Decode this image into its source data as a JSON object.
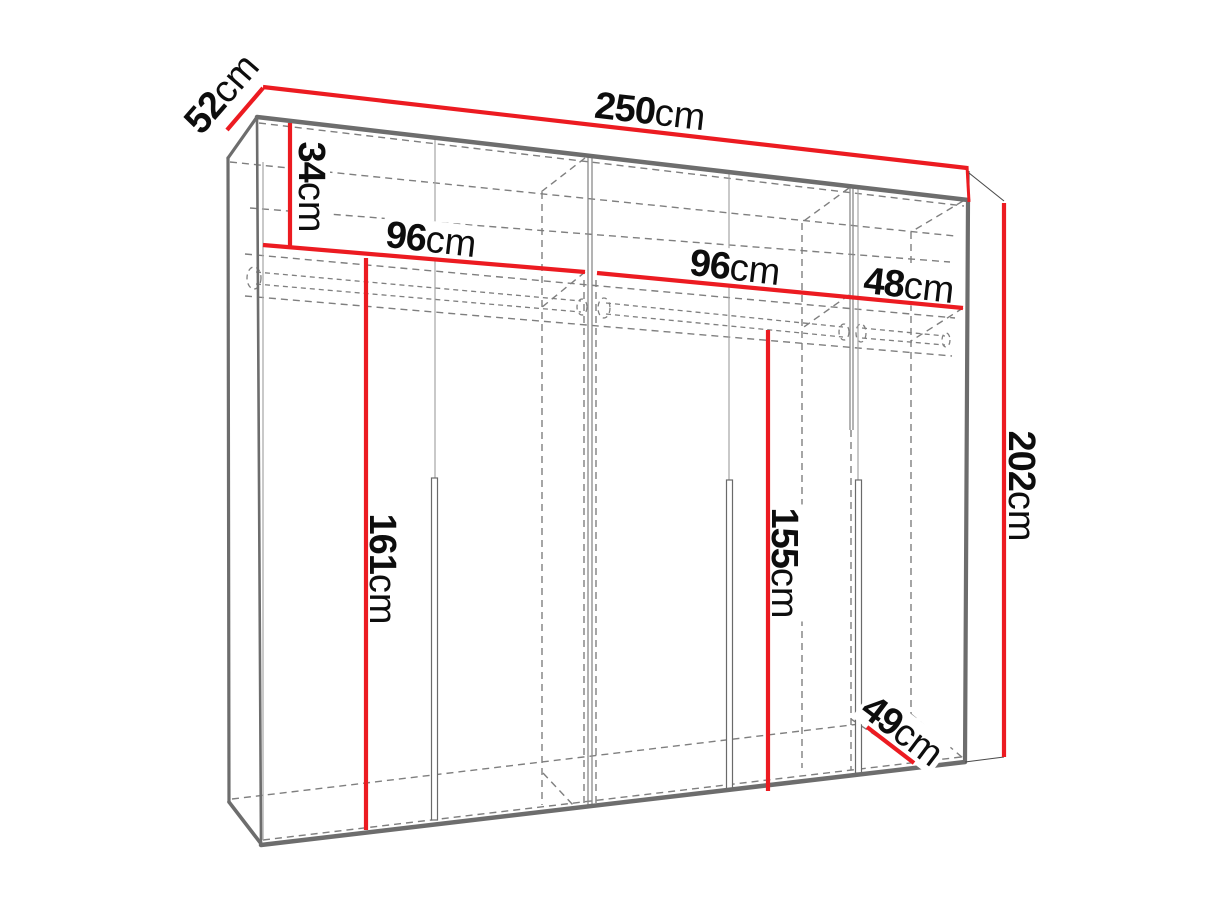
{
  "diagram": {
    "type": "furniture-dimension-diagram",
    "subject": "three-section wardrobe wireframe, two-point perspective",
    "dimensions": [
      {
        "name": "top-depth",
        "value": "52",
        "unit": "cm"
      },
      {
        "name": "total-width",
        "value": "250",
        "unit": "cm"
      },
      {
        "name": "top-compartment-height",
        "value": "34",
        "unit": "cm"
      },
      {
        "name": "left-section-width",
        "value": "96",
        "unit": "cm"
      },
      {
        "name": "middle-section-width",
        "value": "96",
        "unit": "cm"
      },
      {
        "name": "right-section-width",
        "value": "48",
        "unit": "cm"
      },
      {
        "name": "left-hanging-height",
        "value": "161",
        "unit": "cm"
      },
      {
        "name": "right-hanging-height",
        "value": "155",
        "unit": "cm"
      },
      {
        "name": "total-height",
        "value": "202",
        "unit": "cm"
      },
      {
        "name": "bottom-depth",
        "value": "49",
        "unit": "cm"
      }
    ],
    "colors": {
      "dimension_line": "#ec1b21",
      "edge": "#6d6d6d",
      "hidden_edge": "#7f7f7f",
      "thin_line": "#a5a5a5",
      "label_text": "#0d0d0d",
      "background": "#ffffff"
    }
  }
}
